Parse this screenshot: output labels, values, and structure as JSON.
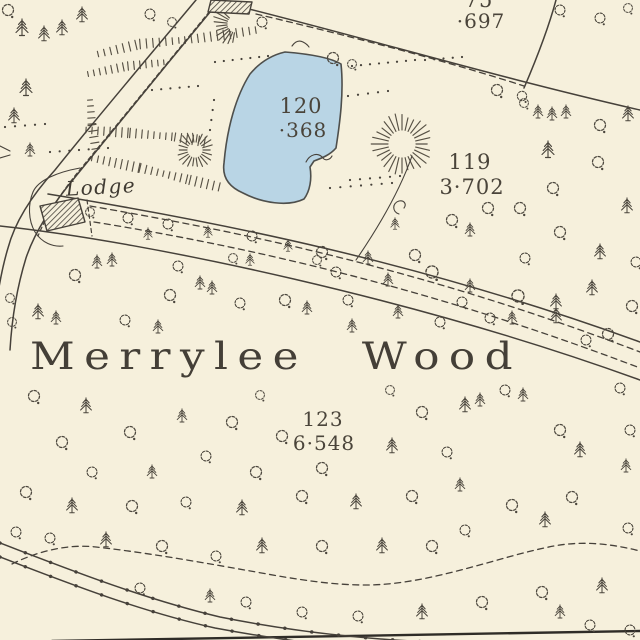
{
  "map": {
    "wood_label": "Merrylee Wood",
    "lodge_label": "Lodge",
    "parcels": [
      {
        "number": "75",
        "acreage": "·697"
      },
      {
        "number": "120",
        "acreage": "·368"
      },
      {
        "number": "119",
        "acreage": "3·702"
      },
      {
        "number": "123",
        "acreage": "6·548"
      }
    ],
    "colors": {
      "paper": "#f6f0dc",
      "ink": "#46413a",
      "ink_text": "#4a443a",
      "tree": "#4a453c",
      "hachure": "#575145",
      "water": "#b9d5e5",
      "water_edge": "#4e4f4c"
    }
  },
  "geometry": {
    "pond": "M285,52 C310,54 331,58 341,64 C344,92 340,122 336,148 C330,155 322,158 314,161 L310,167 C312,179 310,191 304,199 C288,207 262,203 243,193 C229,187 222,177 224,163 C227,128 236,96 250,74 C260,62 272,55 285,52 Z",
    "road_left": "M196,0 C150,55 95,120 55,170 C35,192 16,218 8,248 C2,268 -4,298 -6,330",
    "road_right": "M220,0 C172,58 118,124 76,176 C56,200 36,228 26,258 C18,284 12,316 10,350",
    "road_dash": "M214,6 C168,62 116,126 78,172 C62,192 48,212 38,236",
    "road_bottom_a": "M0,543 C60,566 140,598 220,617 C290,631 360,639 432,642",
    "road_bottom_b": "M0,557 C60,580 135,610 215,628 C268,638 315,644 362,649",
    "footpath_bottom": "M12,564 C40,550 70,544 96,547 C150,553 205,563 256,572 C300,580 332,585 366,585 C430,585 500,556 554,546 C586,540 616,545 640,551",
    "fence_top": "M245,8 C380,42 500,78 640,110",
    "fence_dash_top": "M256,14 C350,36 450,62 524,86",
    "boundary_top": "M556,0 C548,30 536,60 524,88",
    "fence_119": "M412,156 C400,190 380,225 356,260",
    "avenue_upper": "M48,194 C220,222 420,262 640,342",
    "avenue_lower": "M0,226 C150,242 420,300 640,380",
    "avenue_dash1": "M90,206 C240,232 420,268 640,352",
    "avenue_dash2": "M94,222 C250,247 430,288 640,368",
    "lodge_dash": "M87,200 L92,236",
    "enclosure": "M80,168 C58,172 38,180 33,192 C28,204 28,220 35,232 C42,243 53,247 63,246",
    "building_top": "M211,0 L252,2 L249,14 L208,12 Z",
    "building_lodge": "M40,206 L78,198 L85,222 L47,231 Z",
    "marsh_curl": "M306,162 c4,-8 12,-10 17,-4 c2,3 7,2 9,-2",
    "tuft_top": "M292,46 q5,-7 11,-4 q4,2 6,5",
    "hook": "M399,214 c-7,-2 -7,-11 0,-13 c5,-1 8,3 5,7",
    "gate_left": "M0,146 l10,5 m-10,7 l10,-3",
    "border_bottom": "M52,641 L640,631"
  },
  "features": {
    "trees": [
      [
        8,
        10,
        "d",
        1
      ],
      [
        22,
        28,
        "c",
        1
      ],
      [
        44,
        34,
        "c",
        0.9
      ],
      [
        62,
        28,
        "c",
        0.9
      ],
      [
        82,
        15,
        "c",
        0.9
      ],
      [
        150,
        14,
        "d",
        0.9
      ],
      [
        172,
        22,
        "d",
        0.8
      ],
      [
        26,
        88,
        "c",
        1
      ],
      [
        14,
        116,
        "c",
        0.9
      ],
      [
        30,
        150,
        "c",
        0.8
      ],
      [
        262,
        22,
        "d",
        0.9
      ],
      [
        333,
        58,
        "d",
        1
      ],
      [
        352,
        64,
        "d",
        0.8
      ],
      [
        497,
        90,
        "d",
        1
      ],
      [
        522,
        96,
        "d",
        0.85
      ],
      [
        560,
        10,
        "d",
        0.9
      ],
      [
        600,
        18,
        "d",
        0.9
      ],
      [
        628,
        8,
        "d",
        0.8
      ],
      [
        524,
        103,
        "d",
        0.8
      ],
      [
        538,
        112,
        "c",
        0.8
      ],
      [
        552,
        114,
        "c",
        0.8
      ],
      [
        566,
        112,
        "c",
        0.8
      ],
      [
        600,
        125,
        "d",
        1
      ],
      [
        628,
        114,
        "c",
        0.9
      ],
      [
        548,
        150,
        "c",
        1
      ],
      [
        598,
        162,
        "d",
        1
      ],
      [
        553,
        188,
        "d",
        1
      ],
      [
        520,
        208,
        "d",
        1
      ],
      [
        627,
        206,
        "c",
        0.9
      ],
      [
        560,
        232,
        "d",
        1
      ],
      [
        600,
        252,
        "c",
        0.9
      ],
      [
        525,
        258,
        "d",
        0.9
      ],
      [
        636,
        262,
        "d",
        0.9
      ],
      [
        592,
        288,
        "c",
        0.9
      ],
      [
        632,
        306,
        "d",
        1
      ],
      [
        556,
        302,
        "c",
        0.9
      ],
      [
        452,
        220,
        "d",
        1
      ],
      [
        488,
        208,
        "d",
        1
      ],
      [
        470,
        230,
        "c",
        0.8
      ],
      [
        415,
        255,
        "d",
        1
      ],
      [
        395,
        224,
        "c",
        0.7
      ],
      [
        90,
        212,
        "d",
        0.8
      ],
      [
        128,
        218,
        "d",
        0.9
      ],
      [
        168,
        224,
        "d",
        0.9
      ],
      [
        208,
        232,
        "c",
        0.7
      ],
      [
        252,
        236,
        "d",
        0.9
      ],
      [
        288,
        246,
        "c",
        0.7
      ],
      [
        322,
        252,
        "d",
        1
      ],
      [
        368,
        258,
        "c",
        0.8
      ],
      [
        432,
        272,
        "d",
        1.1
      ],
      [
        470,
        286,
        "c",
        0.8
      ],
      [
        518,
        296,
        "d",
        1.1
      ],
      [
        556,
        316,
        "c",
        0.9
      ],
      [
        608,
        334,
        "d",
        1
      ],
      [
        148,
        234,
        "c",
        0.7
      ],
      [
        250,
        260,
        "c",
        0.7
      ],
      [
        336,
        272,
        "d",
        0.9
      ],
      [
        388,
        280,
        "c",
        0.8
      ],
      [
        462,
        302,
        "d",
        0.9
      ],
      [
        512,
        318,
        "c",
        0.8
      ],
      [
        586,
        340,
        "d",
        0.9
      ],
      [
        233,
        258,
        "d",
        0.8
      ],
      [
        317,
        260,
        "d",
        0.8
      ],
      [
        75,
        275,
        "d",
        1
      ],
      [
        97,
        262,
        "c",
        0.8
      ],
      [
        112,
        260,
        "c",
        0.8
      ],
      [
        178,
        266,
        "d",
        0.9
      ],
      [
        170,
        295,
        "d",
        1
      ],
      [
        200,
        283,
        "c",
        0.8
      ],
      [
        212,
        288,
        "c",
        0.8
      ],
      [
        10,
        298,
        "d",
        0.8
      ],
      [
        38,
        312,
        "c",
        0.9
      ],
      [
        56,
        318,
        "c",
        0.8
      ],
      [
        12,
        322,
        "d",
        0.8
      ],
      [
        125,
        320,
        "d",
        0.9
      ],
      [
        158,
        327,
        "c",
        0.8
      ],
      [
        240,
        303,
        "d",
        0.9
      ],
      [
        285,
        300,
        "d",
        1
      ],
      [
        307,
        308,
        "c",
        0.8
      ],
      [
        352,
        326,
        "c",
        0.8
      ],
      [
        398,
        312,
        "c",
        0.8
      ],
      [
        348,
        300,
        "d",
        0.9
      ],
      [
        440,
        322,
        "d",
        0.9
      ],
      [
        490,
        318,
        "d",
        0.9
      ],
      [
        34,
        396,
        "d",
        1
      ],
      [
        86,
        406,
        "c",
        0.9
      ],
      [
        62,
        442,
        "d",
        1
      ],
      [
        130,
        432,
        "d",
        1
      ],
      [
        182,
        416,
        "c",
        0.8
      ],
      [
        232,
        422,
        "d",
        1
      ],
      [
        282,
        436,
        "d",
        1
      ],
      [
        206,
        456,
        "d",
        0.9
      ],
      [
        256,
        472,
        "d",
        1
      ],
      [
        322,
        468,
        "d",
        1
      ],
      [
        390,
        390,
        "d",
        0.8
      ],
      [
        260,
        395,
        "d",
        0.8
      ],
      [
        422,
        412,
        "d",
        1
      ],
      [
        447,
        452,
        "d",
        0.9
      ],
      [
        465,
        405,
        "c",
        0.9
      ],
      [
        480,
        400,
        "c",
        0.8
      ],
      [
        505,
        390,
        "d",
        0.9
      ],
      [
        523,
        395,
        "c",
        0.8
      ],
      [
        620,
        388,
        "d",
        0.9
      ],
      [
        560,
        430,
        "d",
        1
      ],
      [
        580,
        450,
        "c",
        0.9
      ],
      [
        630,
        430,
        "d",
        0.9
      ],
      [
        460,
        485,
        "c",
        0.8
      ],
      [
        392,
        446,
        "c",
        0.9
      ],
      [
        92,
        472,
        "d",
        0.9
      ],
      [
        152,
        472,
        "c",
        0.8
      ],
      [
        512,
        505,
        "d",
        1
      ],
      [
        572,
        497,
        "d",
        1
      ],
      [
        626,
        466,
        "c",
        0.8
      ],
      [
        26,
        492,
        "d",
        1
      ],
      [
        72,
        506,
        "c",
        0.9
      ],
      [
        132,
        506,
        "d",
        1
      ],
      [
        186,
        502,
        "d",
        0.9
      ],
      [
        242,
        508,
        "c",
        0.9
      ],
      [
        302,
        496,
        "d",
        1
      ],
      [
        356,
        502,
        "c",
        0.9
      ],
      [
        412,
        496,
        "d",
        1
      ],
      [
        465,
        530,
        "d",
        0.9
      ],
      [
        545,
        520,
        "c",
        0.9
      ],
      [
        628,
        528,
        "d",
        0.9
      ],
      [
        50,
        538,
        "d",
        0.9
      ],
      [
        106,
        540,
        "c",
        0.9
      ],
      [
        162,
        546,
        "d",
        1
      ],
      [
        216,
        556,
        "d",
        0.9
      ],
      [
        262,
        546,
        "c",
        0.9
      ],
      [
        322,
        546,
        "d",
        1
      ],
      [
        382,
        546,
        "c",
        0.9
      ],
      [
        432,
        546,
        "d",
        1
      ],
      [
        16,
        532,
        "d",
        0.9
      ],
      [
        140,
        588,
        "d",
        0.9
      ],
      [
        210,
        596,
        "c",
        0.8
      ],
      [
        246,
        602,
        "d",
        0.9
      ],
      [
        302,
        612,
        "d",
        0.9
      ],
      [
        358,
        616,
        "d",
        0.9
      ],
      [
        422,
        612,
        "c",
        0.9
      ],
      [
        482,
        602,
        "d",
        1
      ],
      [
        542,
        592,
        "d",
        1
      ],
      [
        602,
        586,
        "c",
        0.9
      ],
      [
        630,
        630,
        "d",
        0.9
      ],
      [
        560,
        612,
        "c",
        0.8
      ],
      [
        590,
        625,
        "d",
        0.9
      ]
    ],
    "dot_rows": [
      [
        215,
        62,
        268,
        56,
        7
      ],
      [
        352,
        66,
        415,
        60,
        8
      ],
      [
        425,
        60,
        462,
        57,
        5
      ],
      [
        348,
        96,
        388,
        91,
        5
      ],
      [
        350,
        180,
        400,
        176,
        6
      ],
      [
        330,
        188,
        392,
        183,
        7
      ],
      [
        5,
        127,
        45,
        124,
        5
      ],
      [
        50,
        152,
        108,
        148,
        7
      ],
      [
        152,
        90,
        198,
        86,
        6
      ],
      [
        214,
        100,
        210,
        130,
        4
      ]
    ],
    "hachure_rings": [
      {
        "cx": 195,
        "cy": 150,
        "r1": 8,
        "r2": 17,
        "n": 22,
        "a0": 0,
        "a1": 360
      },
      {
        "cx": 402,
        "cy": 144,
        "r1": 14,
        "r2": 28,
        "n": 28,
        "a0": 0,
        "a1": 360
      },
      {
        "cx": 236,
        "cy": 24,
        "r1": 9,
        "r2": 21,
        "n": 11,
        "a0": 100,
        "a1": 235
      }
    ],
    "hachure_bands": [
      {
        "pts": [
          [
            98,
            54
          ],
          [
            140,
            44
          ],
          [
            185,
            40
          ],
          [
            230,
            34
          ],
          [
            256,
            30
          ]
        ],
        "t": 8,
        "s": 6.5
      },
      {
        "pts": [
          [
            88,
            74
          ],
          [
            128,
            66
          ],
          [
            168,
            62
          ]
        ],
        "t": 7,
        "s": 6
      },
      {
        "pts": [
          [
            86,
            130
          ],
          [
            130,
            133
          ],
          [
            175,
            137
          ],
          [
            206,
            142
          ]
        ],
        "t": 8,
        "s": 6
      },
      {
        "pts": [
          [
            92,
            158
          ],
          [
            140,
            168
          ],
          [
            190,
            180
          ],
          [
            224,
            188
          ]
        ],
        "t": 8,
        "s": 6
      },
      {
        "pts": [
          [
            90,
            100
          ],
          [
            92,
            125
          ],
          [
            96,
            150
          ]
        ],
        "t": 7,
        "s": 6
      }
    ]
  }
}
